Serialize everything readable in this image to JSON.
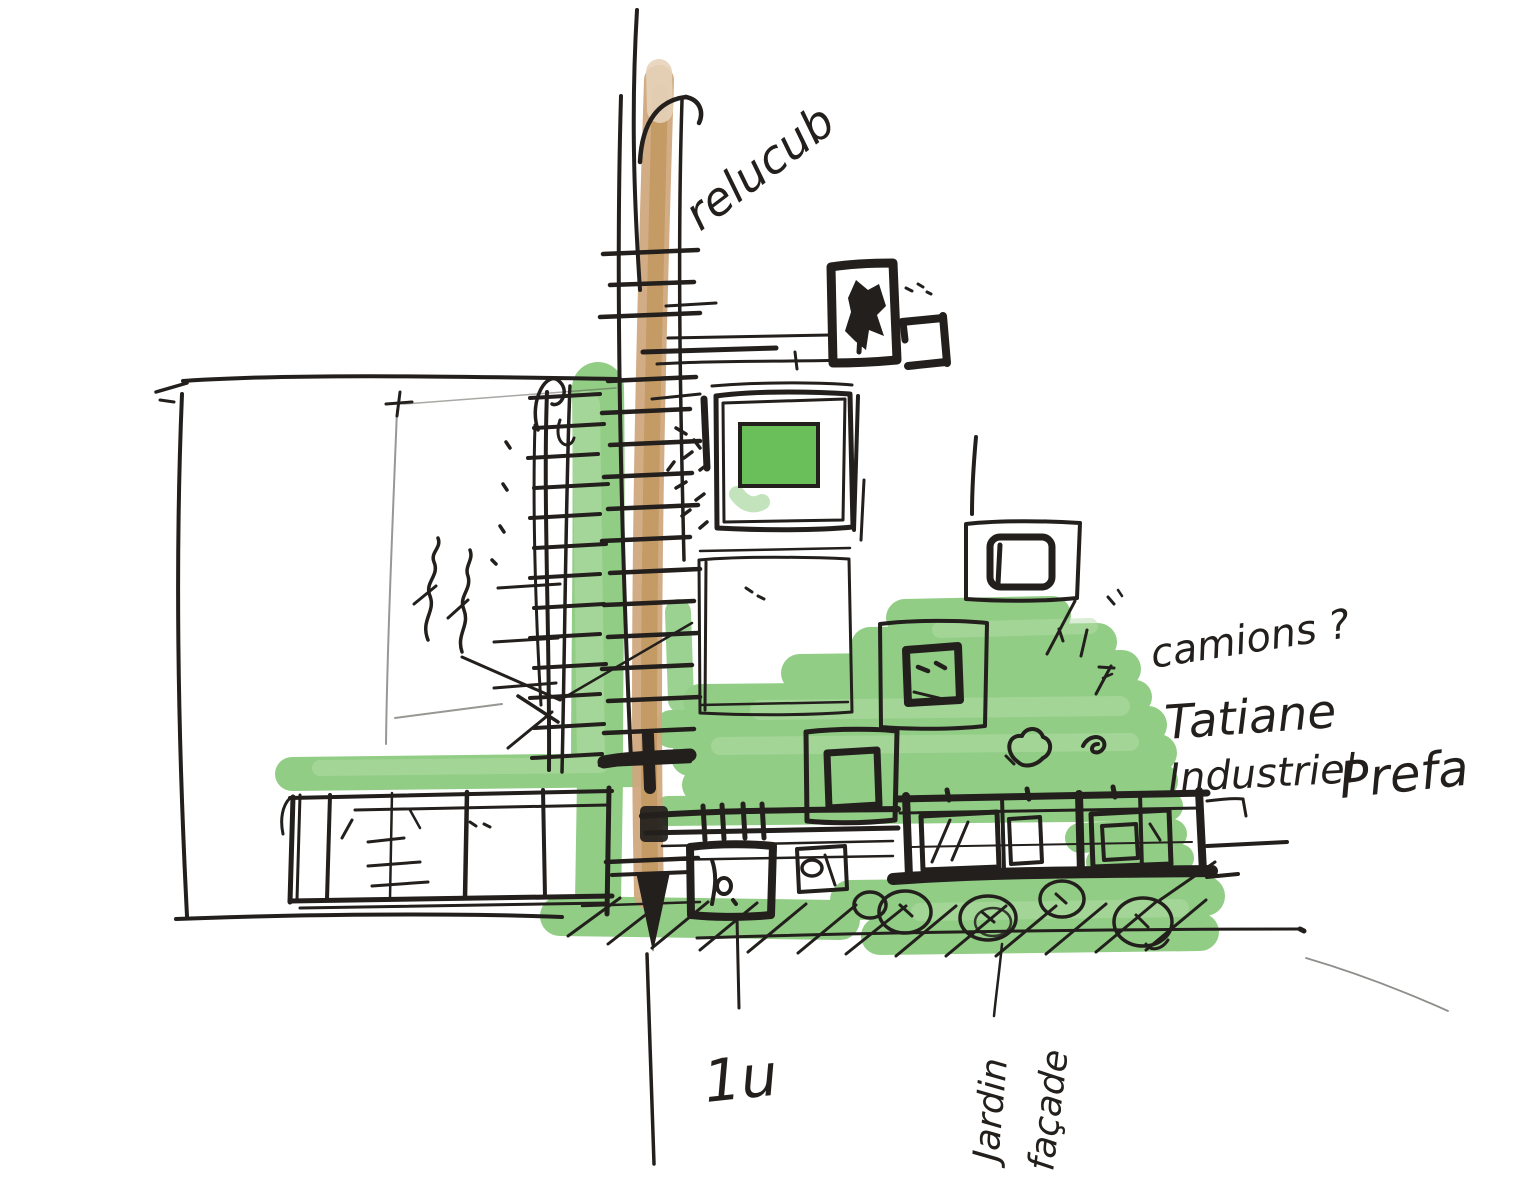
{
  "sketch": {
    "medium": "felt pen and green marker architectural concept sketch",
    "labels": {
      "top_note": "relucub",
      "trucks_question": "camions ?",
      "program_line1": "Tatiane",
      "program_line2": "Industriel",
      "program_line3": "Prefa",
      "dimension_note": "1u",
      "garden_label": "Jardin",
      "facade_label": "façade"
    },
    "colors": {
      "ink": "#221f1c",
      "marker_green": "#76c167",
      "marker_green_light": "#a4d596",
      "trunk_tan": "#c9a176",
      "paper": "#ffffff"
    }
  }
}
